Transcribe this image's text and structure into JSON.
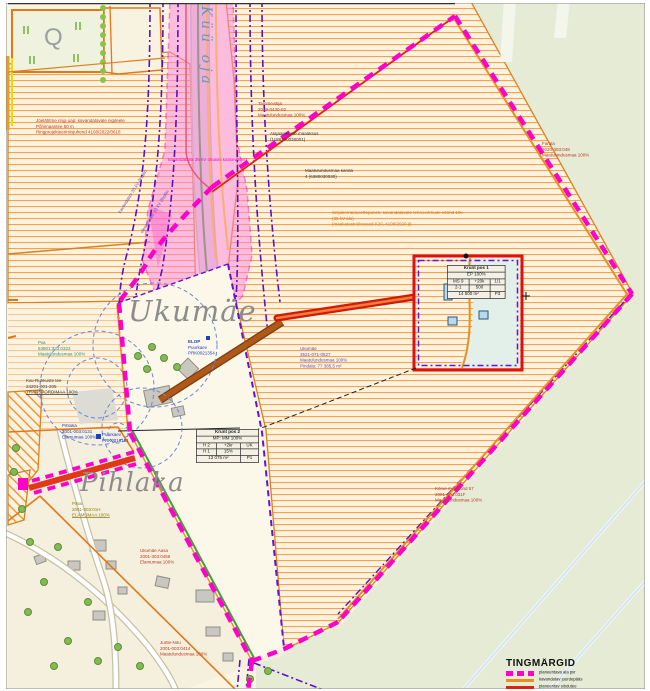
{
  "map": {
    "names": {
      "stream": "Küü oja",
      "ukumae": "Ukumäe",
      "pihlaka": "Pihlaka",
      "quarry_symbol": "Q"
    },
    "annotations": {
      "restriction_note": {
        "l1": "Jõelähtme ringi uap: kavandatavale riigiteele",
        "l2": "Põhimaantee 50 m",
        "l3": "Ringprojekteerimisjuhend 4108/2022/0618"
      },
      "substation": {
        "l1": "Alajaanikuste maaüksus",
        "l2": "(1188200030001)"
      },
      "tammevalja": {
        "l1": "Tammevälja",
        "l2": "2019-0430-02",
        "l3": "Maatulundusmaa 100%"
      },
      "maatulundus_note": {
        "l1": "Maatulundusmaa kanda",
        "l2": "4 (6380030030)"
      },
      "servituut_note": {
        "l1": "Seljakorraldusettepanek: kavandatavate tehnovõrkude vöönd 10k",
        "l2": "(35 kV ala)",
        "l3": "(maakatastriüksused K20, 4108/2020 jt)"
      },
      "farula": {
        "l1": "Farula",
        "l2": "2020-303:048",
        "l3": "Maatulundusmaa 100%"
      },
      "ohuliin_note": "kavandatava 35 kV õhuliini kaitsevöönd",
      "elop": {
        "l1": "ELOP",
        "l2": "Puurkaev",
        "l3": "PRK0021354"
      },
      "ukumae_parcel": {
        "l1": "Ukumäe",
        "l2": "3521-071-0527",
        "l3": "Maatulundusmaa 100%",
        "l4": "Pindala: 77 385,5 m²"
      },
      "piia": {
        "l1": "Piia",
        "l2": "63801:333:0323",
        "l3": "Maatulundusmaa 100%"
      },
      "kiiu_tee": {
        "l1": "Kiiu-Ruhkuste tee",
        "l2": "24201-001-205",
        "l3": "TRANSPORDIMAA 100%"
      },
      "pihlaka_parcel": {
        "l1": "Pihlaka",
        "l2": "2001-003:0131",
        "l3": "Elamumaa 100%"
      },
      "puurkaev2": {
        "l1": "Puurkaev",
        "l2": "PRK0013151"
      },
      "pihla": {
        "l1": "Pihla",
        "l2": "2001-003:01H",
        "l3": "ELAMUMAA 100%"
      },
      "ukumae_aasa": {
        "l1": "Ukumäe Aasa",
        "l2": "2001-303:0456",
        "l3": "Elamumaa 100%"
      },
      "jurtle": {
        "l1": "Jurtle-Nõu",
        "l2": "2001-003:0414",
        "l3": "Maatulundusmaa 100%"
      },
      "metskond": {
        "l1": "Kõrve metskond 57",
        "l2": "2001-303:031F",
        "l3": "Maatulundusmaa 100%"
      },
      "ohuliin_rot1": "kavandatav 35 kV õhuliin",
      "ohuliin_rot2": "olemasolev 10 kV õhuliin"
    },
    "tables": {
      "pos1": {
        "title": "Krunt pos 1",
        "util": "EP 100%",
        "g00": "MS 9",
        "g01": "+20k",
        "g02": "1/1",
        "g10": "2-1",
        "g11": "500",
        "g12": "",
        "area": "14 500 m²",
        "mark": "P3"
      },
      "pos2": {
        "title": "Krunt pos 2",
        "util": "MP: MM 100%",
        "g00": "H 2",
        "g01": "+2kr",
        "g02": "UK",
        "g10": "H 1",
        "g11": "15%",
        "g12": "",
        "area": "13 075 m²",
        "mark": "P1"
      }
    },
    "legend": {
      "title": "TINGMÄRGID",
      "items": [
        {
          "label": "planeeritava ala piir"
        },
        {
          "label": "kavandatav juurdepääs"
        },
        {
          "label": "planeeritav sõidutee"
        },
        {
          "label": "olemasolev mahasõit"
        }
      ]
    },
    "colors": {
      "boundary_magenta": "#ff00cc",
      "corridor_pink": "#ff86dd",
      "road_orange": "#e8901c",
      "access_red": "#e02010",
      "utility_purple": "#5a10c8",
      "green_line": "#3fa03a",
      "farmland_hatch": "#f0a351",
      "forest_green": "#e6ebd6",
      "base_cream": "#faf4e1"
    }
  }
}
